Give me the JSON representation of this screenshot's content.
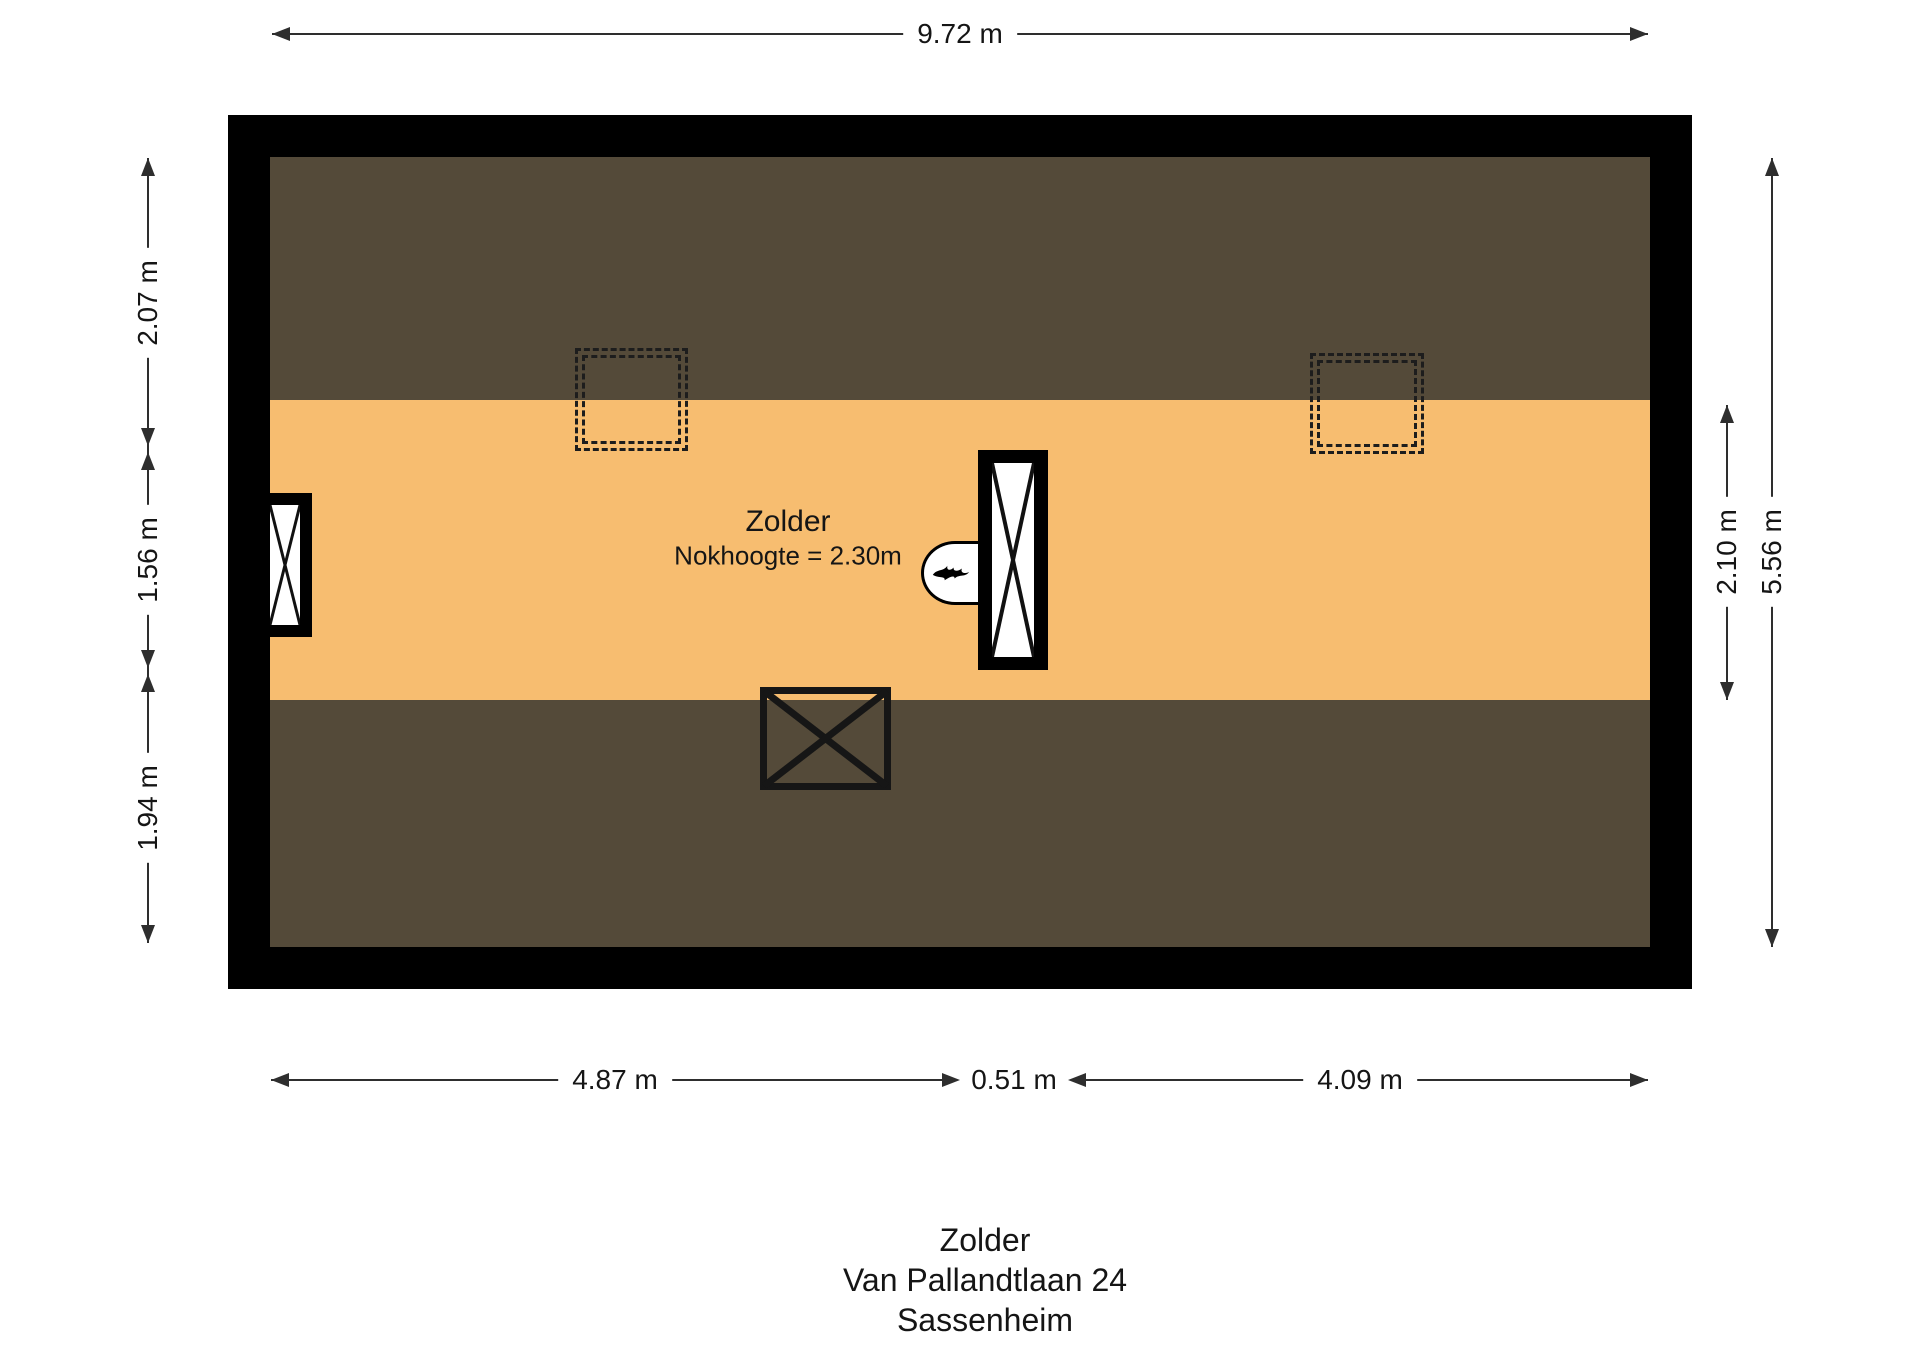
{
  "dimensions": {
    "top": {
      "label": "9.72 m"
    },
    "left": [
      {
        "label": "2.07 m"
      },
      {
        "label": "1.56 m"
      },
      {
        "label": "1.94 m"
      }
    ],
    "right": [
      {
        "label": "2.10 m"
      },
      {
        "label": "5.56 m"
      }
    ],
    "bottom": [
      {
        "label": "4.87 m"
      },
      {
        "label": "0.51 m"
      },
      {
        "label": "4.09 m"
      }
    ]
  },
  "room": {
    "name": "Zolder",
    "ridge_note": "Nokhoogte = 2.30m"
  },
  "title_block": {
    "room": "Zolder",
    "address": "Van Pallandtlaan 24",
    "city": "Sassenheim"
  },
  "colors": {
    "wall": "#000000",
    "roof": "#544a39",
    "floor": "#f7bd70",
    "line": "#2e2e2e",
    "text": "#151515",
    "bg": "#ffffff"
  }
}
